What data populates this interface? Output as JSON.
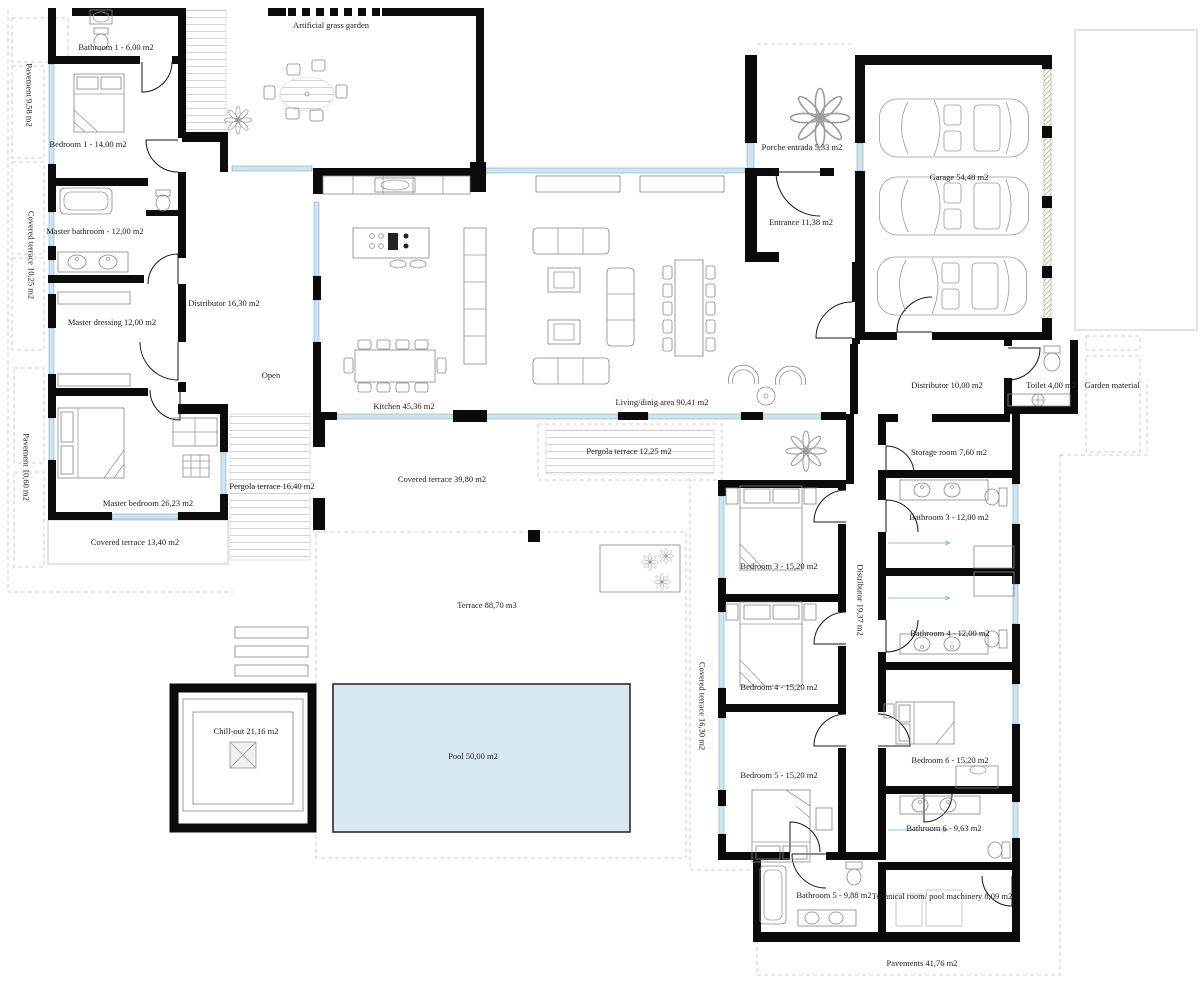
{
  "colors": {
    "wall": "#0b0b0b",
    "window": "#cfe4ef",
    "pool": "#d9e9f2",
    "label": "#1c1c1c"
  },
  "rooms": {
    "pavement_nw": "Pavement 9,58 m2",
    "covered_terrace_west": "Covered terrace 10,25 m2",
    "pavement_w": "Pavement 10,60 m2",
    "bathroom_1": "Bathroom 1 - 6,00 m2",
    "bedroom_1": "Bedroom 1 - 14,00 m2",
    "artificial_grass_garden": "Artificial grass garden",
    "master_bathroom": "Master bathroom - 12,00 m2",
    "master_dressing": "Master dressing 12,00 m2",
    "distributor_hall": "Distributor 16,30 m2",
    "open_stair": "Open",
    "master_bedroom": "Master bedroom 26,23 m2",
    "covered_terrace_master": "Covered terrace 13,40 m2",
    "pergola_terrace_west": "Pergola terrace 16,40 m2",
    "kitchen": "Kitchen 45,36 m2",
    "living_dining": "Living/dinig area 90,41 m2",
    "covered_terrace_main": "Covered terrace 39,80 m2",
    "pergola_terrace_south": "Pergola terrace 12,25 m2",
    "porche_entrada": "Porche entrada 5,33 m2",
    "entrance": "Entrance 11,38 m2",
    "garage": "Garage 54,48 m2",
    "distributor_garage": "Distributor 10,00 m2",
    "toilet": "Toilet 4,00 m2",
    "garden_material": "Garden material",
    "storage_room": "Storage room 7,60 m2",
    "bedroom_3": "Bedroom 3 - 15,20 m2",
    "bathroom_3": "Bathroom 3 - 12,00 m2",
    "distributor_bedrooms": "Distributor 19,37 m2",
    "bathroom_4": "Bathroom 4 - 12,00 m2",
    "bedroom_4": "Bedroom 4 - 15,20 m2",
    "covered_terrace_east": "Covered terrace 16,30 m2",
    "bedroom_5": "Bedroom 5 - 15,20 m2",
    "bedroom_6": "Bedroom 6 - 15,20 m2",
    "bathroom_6": "Bathroom 6 - 9,63 m2",
    "bathroom_5": "Bathroom 5 - 9,88 m2",
    "technical_room": "Technical room/ pool machinery 8,09 m2",
    "pavements_south": "Pavements 41,76 m2",
    "terrace": "Terrace 88,70 m3",
    "chill_out": "Chill-out 21,16 m2",
    "pool": "Pool 50,00 m2"
  }
}
